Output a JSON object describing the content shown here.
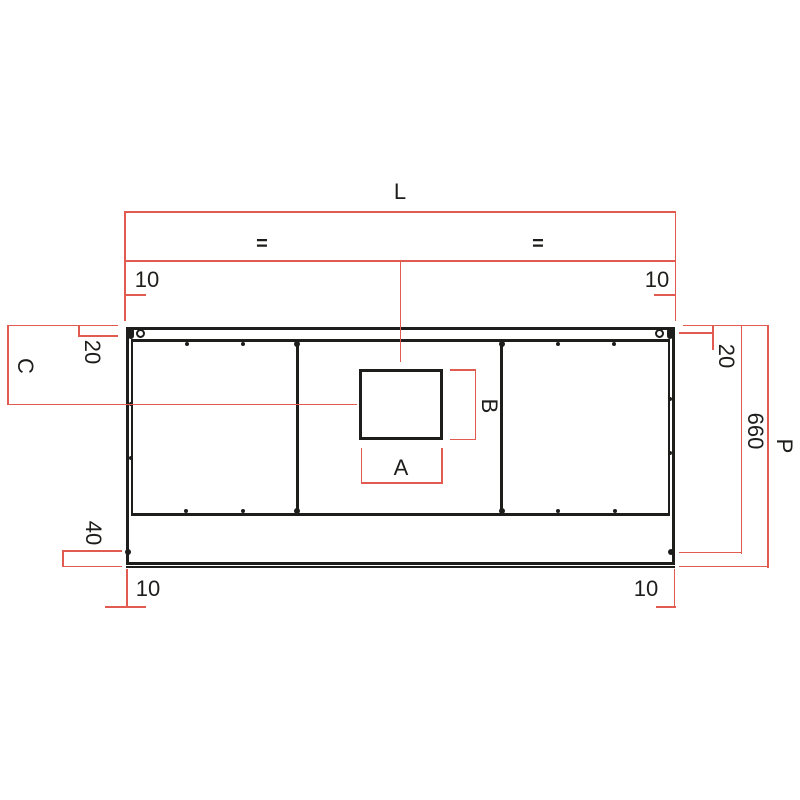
{
  "drawing": {
    "title": "worktop-cutout-dimension-drawing",
    "colors": {
      "dimension_red": "#e25b50",
      "line_black": "#1d1d1b"
    },
    "dimensions": {
      "total_length": "L",
      "equal_left": "=",
      "equal_right": "=",
      "top_left_offset": "10",
      "top_right_offset": "10",
      "left_edge_inset": "20",
      "right_edge_inset": "20",
      "center_depth_label": "C",
      "cutout_width": "A",
      "cutout_height": "B",
      "front_rail_height": "40",
      "bottom_left_offset": "10",
      "bottom_right_offset": "10",
      "depth_to_fixing": "660",
      "total_depth": "P"
    }
  }
}
